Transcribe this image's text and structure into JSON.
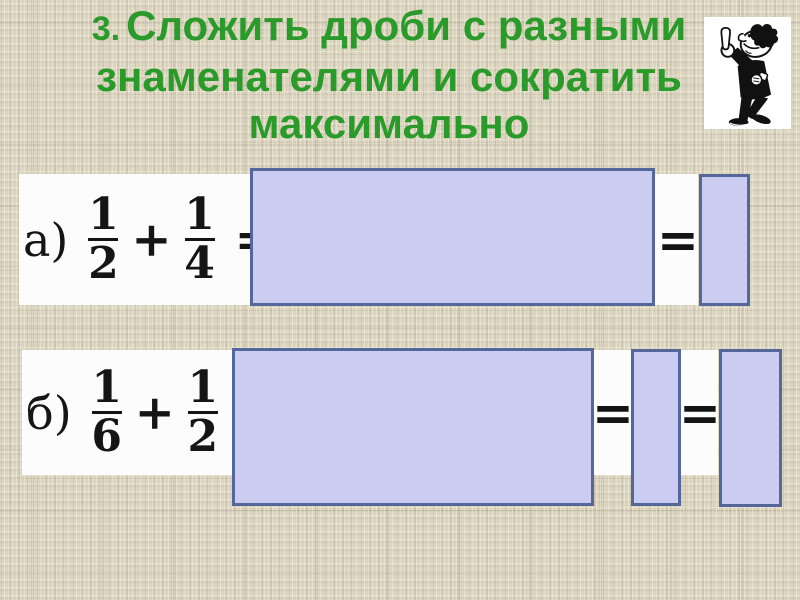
{
  "slide": {
    "title": {
      "number": "3.",
      "line1": "Сложить дроби с разными",
      "line2": "знаменателями и сократить",
      "line3": "максимально"
    },
    "mascot_icon": "pointing-man-clipart"
  },
  "problems": [
    {
      "label": "а)",
      "frac1": {
        "num": "1",
        "den": "2"
      },
      "plus": "+",
      "frac2": {
        "num": "1",
        "den": "4"
      },
      "eq_after": "=",
      "eq_mid": "="
    },
    {
      "label": "б)",
      "frac1": {
        "num": "1",
        "den": "6"
      },
      "plus": "+",
      "frac2": {
        "num": "1",
        "den": "2"
      },
      "eq_after": "=",
      "eq_mid1": "=",
      "eq_mid2": "="
    }
  ],
  "colors": {
    "title_green": "#2a9b2a",
    "background_beige": "#dcd4bc",
    "strip_white": "#fcfcfc",
    "cover_fill": "#cbccf2",
    "cover_border": "#55679a"
  }
}
